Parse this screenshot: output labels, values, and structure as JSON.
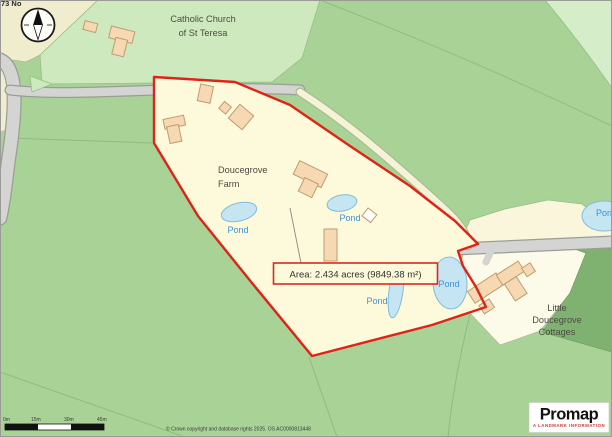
{
  "map": {
    "corner_text": "73 No",
    "labels": {
      "church": [
        "Catholic Church",
        "of St Teresa"
      ],
      "farm": [
        "Doucegrove",
        "Farm"
      ],
      "cottages": [
        "Little",
        "Doucegrove",
        "Cottages"
      ],
      "pond": "Pond"
    },
    "annotation": {
      "area": "Area: 2.434 acres (9849.38 m²)"
    }
  },
  "scale_bar": {
    "ticks": [
      "0m",
      "15m",
      "30m",
      "45m"
    ]
  },
  "footer": {
    "copyright": "© Crown copyright and database rights 2025. OS AC0000813448"
  },
  "logo": {
    "name": "Promap",
    "tagline": "A LANDMARK INFORMATION"
  },
  "colors": {
    "boundary_red": "#E02318",
    "parcel_yellow": "#FDFADB",
    "field_green": "#A8D296",
    "light_green": "#CEE9BE",
    "woodland_green": "#7FB270",
    "pond_blue": "#C5E5F3",
    "pond_text_blue": "#3E92D3",
    "road_gray": "#D4D4D2",
    "building_tan": "#F6D8B2",
    "cream": "#F0EDCF"
  }
}
